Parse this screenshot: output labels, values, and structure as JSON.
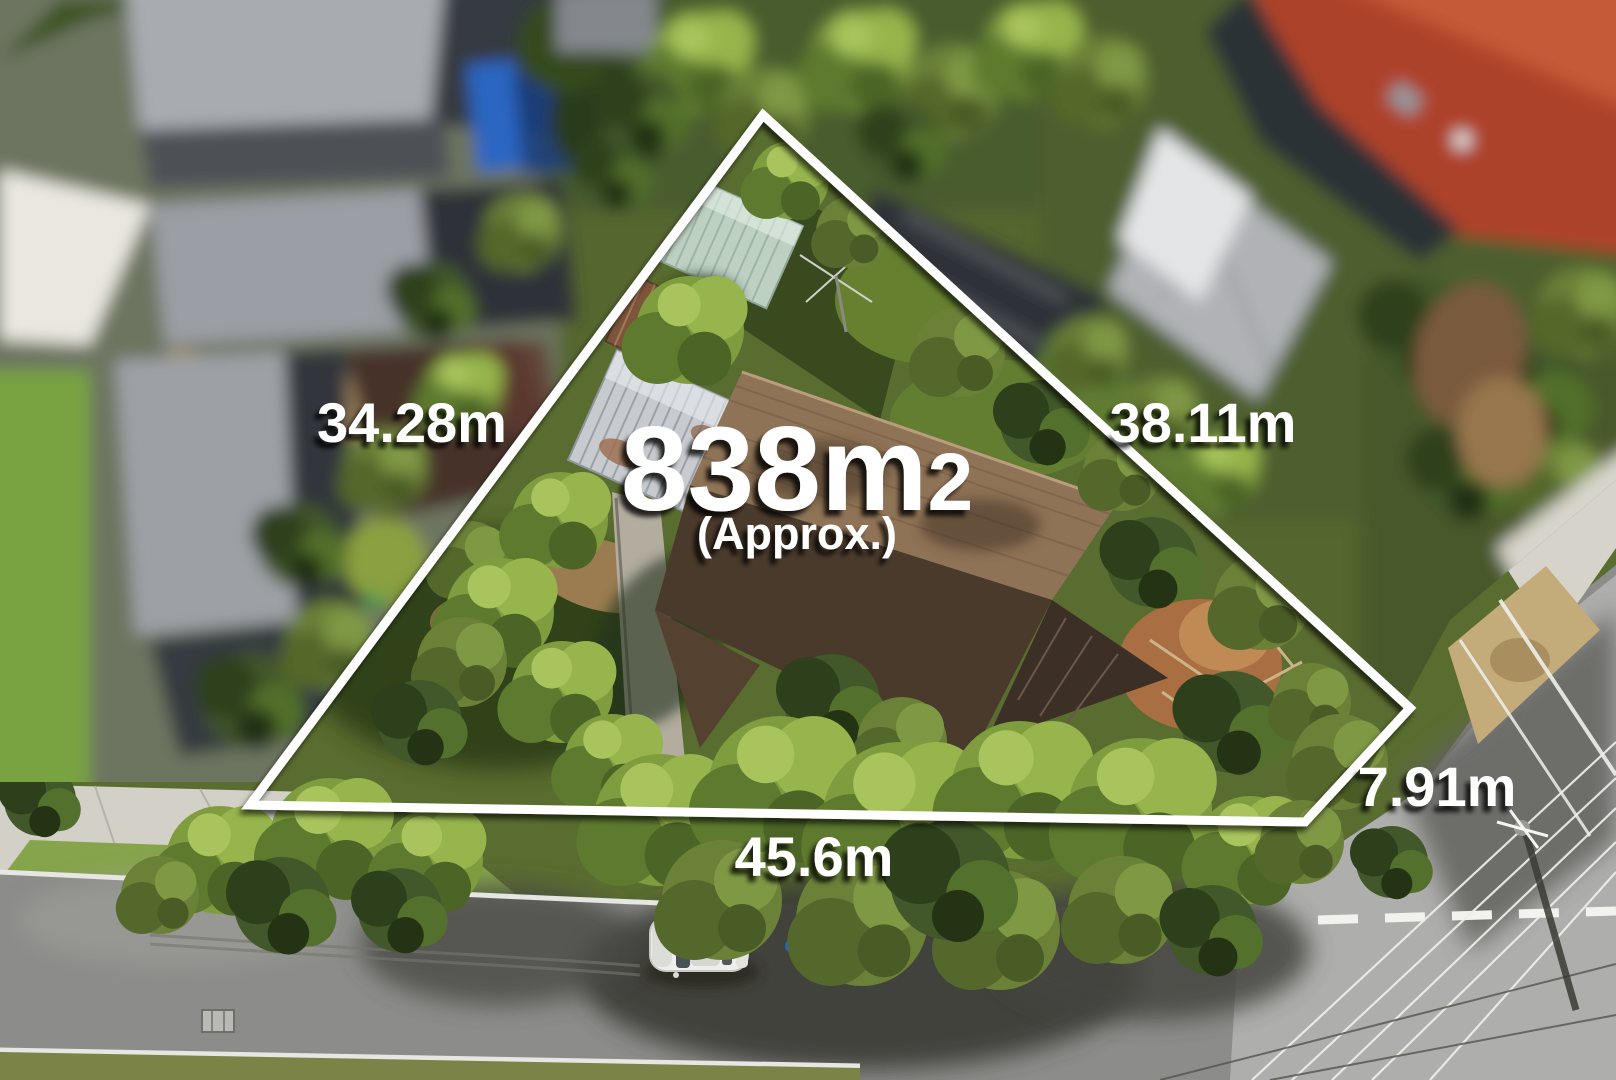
{
  "overlay": {
    "area": {
      "value": "838m",
      "superscript": "2",
      "qualifier": "(Approx.)"
    },
    "sides": {
      "left": "34.28m",
      "right": "38.11m",
      "bottom": "45.6m",
      "corner": "7.91m"
    }
  },
  "colors": {
    "boundary": "#ffffff",
    "label_text": "#ffffff"
  }
}
